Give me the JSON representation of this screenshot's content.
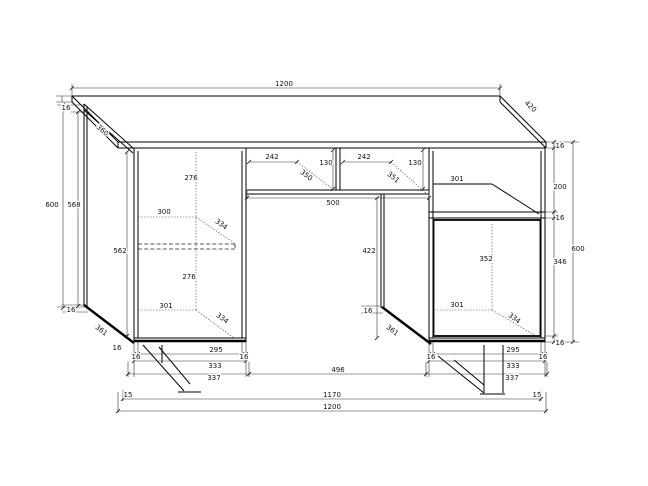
{
  "page": {
    "background": "#ffffff",
    "line_color": "#000000"
  },
  "drawing": {
    "type": "furniture-dimension-drawing",
    "units": "mm",
    "overall": {
      "width": "1200",
      "depth": "420",
      "height": "600"
    },
    "labels": [
      {
        "name": "top-width",
        "text": "1200",
        "x": 284,
        "y": 86
      },
      {
        "name": "desktop-depth",
        "text": "420",
        "x": 529,
        "y": 108,
        "rot": 43
      },
      {
        "name": "desktop-thickness-left",
        "text": "16",
        "x": 66,
        "y": 110
      },
      {
        "name": "side-panel-depth-left",
        "text": "360",
        "x": 101,
        "y": 132,
        "rot": 41
      },
      {
        "name": "desktop-thickness-right",
        "text": "16",
        "x": 560,
        "y": 148
      },
      {
        "name": "height-overall-left",
        "text": "600",
        "x": 52,
        "y": 207
      },
      {
        "name": "side-panel-height-left",
        "text": "568",
        "x": 74,
        "y": 207
      },
      {
        "name": "left-upper-space-height",
        "text": "276",
        "x": 191,
        "y": 180
      },
      {
        "name": "left-shelf-width",
        "text": "300",
        "x": 164,
        "y": 214
      },
      {
        "name": "left-shelf-depth-upper",
        "text": "334",
        "x": 220,
        "y": 226,
        "rot": 36
      },
      {
        "name": "left-inner-height",
        "text": "562",
        "x": 120,
        "y": 253
      },
      {
        "name": "left-lower-space-height",
        "text": "276",
        "x": 189,
        "y": 279
      },
      {
        "name": "left-bottom-inner-width",
        "text": "301",
        "x": 166,
        "y": 308
      },
      {
        "name": "left-shelf-depth-lower",
        "text": "334",
        "x": 221,
        "y": 320,
        "rot": 36
      },
      {
        "name": "left-panel-bottom-thickness",
        "text": "16",
        "x": 71,
        "y": 312
      },
      {
        "name": "left-panel-bottom-depth",
        "text": "361",
        "x": 100,
        "y": 332,
        "rot": 38
      },
      {
        "name": "left-panel-front-thickness",
        "text": "16",
        "x": 117,
        "y": 350
      },
      {
        "name": "drawer-left-width",
        "text": "242",
        "x": 272,
        "y": 159
      },
      {
        "name": "drawer-middle-height",
        "text": "130",
        "x": 326,
        "y": 165
      },
      {
        "name": "drawer-right-width",
        "text": "242",
        "x": 364,
        "y": 159
      },
      {
        "name": "drawer-left-depth",
        "text": "350",
        "x": 305,
        "y": 177,
        "rot": 38
      },
      {
        "name": "drawer-right-depth",
        "text": "351",
        "x": 392,
        "y": 179,
        "rot": 38
      },
      {
        "name": "drawer-right-height",
        "text": "130",
        "x": 415,
        "y": 165
      },
      {
        "name": "middle-opening-width",
        "text": "500",
        "x": 333,
        "y": 205
      },
      {
        "name": "middle-opening-height",
        "text": "422",
        "x": 369,
        "y": 253
      },
      {
        "name": "right-panel-bottom-thickness",
        "text": "16",
        "x": 368,
        "y": 313
      },
      {
        "name": "right-panel-bottom-depth",
        "text": "361",
        "x": 391,
        "y": 332,
        "rot": 38
      },
      {
        "name": "niche-width",
        "text": "301",
        "x": 457,
        "y": 181
      },
      {
        "name": "niche-height",
        "text": "200",
        "x": 560,
        "y": 189
      },
      {
        "name": "right-shelf-thickness",
        "text": "16",
        "x": 560,
        "y": 220
      },
      {
        "name": "right-cabinet-inner-height",
        "text": "352",
        "x": 486,
        "y": 261
      },
      {
        "name": "right-cabinet-height",
        "text": "346",
        "x": 560,
        "y": 264
      },
      {
        "name": "height-overall-right",
        "text": "600",
        "x": 578,
        "y": 251
      },
      {
        "name": "right-cabinet-inner-width",
        "text": "301",
        "x": 457,
        "y": 307
      },
      {
        "name": "right-shelf-depth",
        "text": "334",
        "x": 513,
        "y": 320,
        "rot": 36
      },
      {
        "name": "right-bottom-thickness",
        "text": "16",
        "x": 560,
        "y": 345
      },
      {
        "name": "left-plinth-left-thickness",
        "text": "16",
        "x": 136,
        "y": 359
      },
      {
        "name": "left-plinth-width",
        "text": "295",
        "x": 216,
        "y": 352
      },
      {
        "name": "left-plinth-right-thickness",
        "text": "16",
        "x": 244,
        "y": 359
      },
      {
        "name": "left-pedestal-width",
        "text": "333",
        "x": 215,
        "y": 368
      },
      {
        "name": "left-pedestal-outer-width",
        "text": "337",
        "x": 214,
        "y": 380
      },
      {
        "name": "middle-gap-width",
        "text": "496",
        "x": 338,
        "y": 372
      },
      {
        "name": "right-plinth-left-thickness",
        "text": "16",
        "x": 431,
        "y": 359
      },
      {
        "name": "right-plinth-width",
        "text": "295",
        "x": 513,
        "y": 352
      },
      {
        "name": "right-plinth-right-thickness",
        "text": "16",
        "x": 543,
        "y": 359
      },
      {
        "name": "right-pedestal-width",
        "text": "333",
        "x": 513,
        "y": 368
      },
      {
        "name": "right-pedestal-outer-width",
        "text": "337",
        "x": 512,
        "y": 380
      },
      {
        "name": "foot-inset-left",
        "text": "15",
        "x": 128,
        "y": 397
      },
      {
        "name": "feet-span",
        "text": "1170",
        "x": 332,
        "y": 397
      },
      {
        "name": "foot-inset-right",
        "text": "15",
        "x": 537,
        "y": 397
      },
      {
        "name": "bottom-overall-width",
        "text": "1200",
        "x": 332,
        "y": 409
      }
    ]
  }
}
